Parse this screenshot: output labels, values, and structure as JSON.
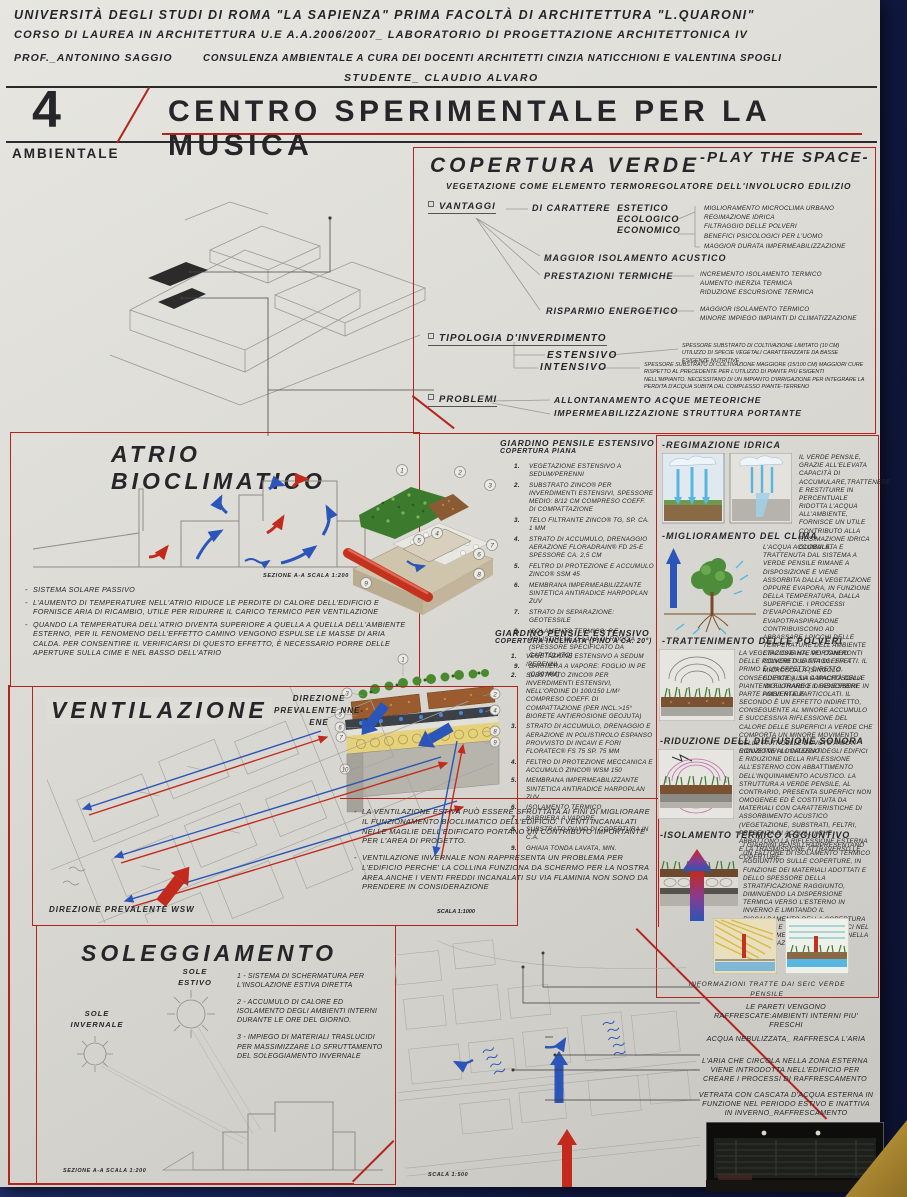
{
  "colors": {
    "accent_red": "#b2251f",
    "arrow_blue": "#2b55b8",
    "arrow_red": "#c32a1e",
    "paper": "#dcdbd5",
    "background_navy": "#121a44"
  },
  "header": {
    "line1": "UNIVERSITÀ DEGLI STUDI DI ROMA \"LA SAPIENZA\" PRIMA FACOLTÀ DI ARCHITETTURA \"L.QUARONI\"",
    "line2": "CORSO DI LAUREA IN ARCHITETTURA U.E  A.A.2006/2007_  LABORATORIO DI PROGETTAZIONE ARCHITETTONICA IV",
    "prof": "PROF._ANTONINO SAGGIO",
    "consulenza": "CONSULENZA AMBIENTALE A CURA DEI DOCENTI ARCHITETTI CINZIA NATICCHIONI E VALENTINA SPOGLI",
    "studente": "STUDENTE_ CLAUDIO ALVARO"
  },
  "title_block": {
    "number": "4",
    "label": "AMBIENTALE",
    "title": "CENTRO SPERIMENTALE PER LA MUSICA",
    "tagline": "-PLAY THE SPACE-"
  },
  "copertura_verde": {
    "title": "COPERTURA VERDE",
    "subtitle": "VEGETAZIONE COME ELEMENTO TERMOREGOLATORE DELL'INVOLUCRO EDILIZIO",
    "vantaggi_label": "VANTAGGI",
    "carattere_label": "DI CARATTERE",
    "caratteri": [
      "ESTETICO",
      "ECOLOGICO",
      "ECONOMICO"
    ],
    "caratteri_effetti": [
      "MIGLIORAMENTO MICROCLIMA URBANO",
      "REGIMAZIONE IDRICA",
      "FILTRAGGIO DELLE POLVERI",
      "BENEFICI PSICOLOGICI PER L'UOMO"
    ],
    "durata": "MAGGIOR DURATA IMPERMEABILIZZAZIONE",
    "acustico": "MAGGIOR ISOLAMENTO ACUSTICO",
    "prestazioni_label": "PRESTAZIONI TERMICHE",
    "prestazioni": [
      "INCREMENTO ISOLAMENTO TERMICO",
      "AUMENTO INERZIA TERMICA",
      "RIDUZIONE ESCURSIONE TERMICA"
    ],
    "risparmio_label": "RISPARMIO ENERGETICO",
    "risparmio": [
      "MAGGIOR ISOLAMENTO TERMICO",
      "MINORE IMPIEGO IMPIANTI DI CLIMATIZZAZIONE"
    ],
    "tipologia_label": "TIPOLOGIA D'INVERDIMENTO",
    "estensivo_label": "ESTENSIVO",
    "estensivo_text": "SPESSORE SUBSTRATO DI COLTIVAZIONE LIMITATO (10 CM) UTILIZZO DI SPECIE VEGETALI CARATTERIZZATE DA BASSE ESIGENZE NUTRITIVE",
    "intensivo_label": "INTENSIVO",
    "intensivo_text": "SPESSORE SUBSTRATO DI COLTIVAZIONE MAGGIORE (15/100 CM) MAGGIORI CURE RISPETTO AL PRECEDENTE PER L'UTILIZZO DI PIANTE PIÙ ESIGENTI NELL'IMPIANTO. NECESSITANO DI UN IMPIANTO D'IRRIGAZIONE PER INTEGRARE LA PERDITA D'ACQUA SUBITA DAL COMPLESSO PIANTE-TERRENO",
    "problemi_label": "PROBLEMI",
    "problemi": [
      "ALLONTANAMENTO ACQUE METEORICHE",
      "IMPERMEABILIZZAZIONE STRUTTURA PORTANTE"
    ]
  },
  "atrio": {
    "title": "ATRIO BIOCLIMATICO",
    "caption": "SEZIONE A-A SCALA 1:200",
    "bullets": [
      "SISTEMA SOLARE PASSIVO",
      "L'AUMENTO DI TEMPERATURE NELL'ATRIO RIDUCE LE PERDITE DI CALORE DELL'EDIFICIO E FORNISCE ARIA DI RICAMBIO, UTILE PER RIDURRE IL CARICO TERMICO PER VENTILAZIONE",
      "QUANDO LA TEMPERATURA DELL'ATRIO DIVENTA SUPERIORE A QUELLA A QUELLA DELL'AMBIENTE ESTERNO, PER IL FENOMENO DELL'EFFETTO CAMINO VENGONO ESPULSE LE MASSE DI ARIA CALDA. PER CONSENTIRE IL VERIFICARSI DI QUESTO EFFETTO, È NECESSARIO PORRE DELLE APERTURE SULLA CIME E NEL BASSO DELL'ATRIO"
    ]
  },
  "giardino_piana": {
    "title": "GIARDINO PENSILE ESTENSIVO",
    "subtitle": "COPERTURA PIANA",
    "items": [
      "VEGETAZIONE ESTENSIVO A SEDUM/PERENNI",
      "SUBSTRATO ZINCO® PER INVERDIMENTI ESTENSIVI, SPESSORE MEDIO: 8/12 CM COMPRESO COEFF. DI COMPATTAZIONE",
      "TELO FILTRANTE ZINCO® TG, SP. CA. 1 MM",
      "STRATO DI ACCUMULO, DRENAGGIO AERAZIONE FLORADRAIN® FD 25-E SPESSORE CA. 2,5 CM",
      "FELTRO DI PROTEZIONE E ACCUMULO ZINCO® SSM 45",
      "MEMBRANA IMPERMEABILIZZANTE SINTETICA ANTIRADICE HARPOPLAN ZUV",
      "STRATO DI SEPARAZIONE: GEOTESSILE",
      "ISOLAMENTO TERMICO: P.E. POLISTIRENE O LANA DI ROCCIA (SPESSORE SPECIFICATO DA CAPITOLATO)",
      "BARRIERA A VAPORE: FOGLIO IN PE (0,30 MM)"
    ]
  },
  "giardino_inclinata": {
    "title": "GIARDINO PENSILE ESTENSIVO",
    "subtitle": "COPERTURA INCLINATA (FINO A CA. 20°)",
    "items": [
      "VEGETAZIONE ESTENSIVO A SEDUM /PERENNI",
      "SUBSTRATO ZINCO® PER INVERDIMENTI ESTENSIVI, NELL'ORDINE DI 100/150 L/M² COMPRESO COEFF. DI COMPATTAZIONE (PER INCL.>15° BIORETE ANTIEROSIONE GEOJUTA)",
      "STRATO DI ACCUMULO, DRENAGGIO E AERAZIONE IN POLISTIROLO ESPANSO PROVVISTO DI INCAVI E FORI FLORATEC® FS 75 SP. 75 MM",
      "FELTRO DI PROTEZIONE MECCANICA E ACCUMULO ZINCO® WSM 150",
      "MEMBRANA IMPERMEABILIZZANTE SINTETICA ANTIRADICE HARPOPLAN ZUV",
      "ISOLAMENTO TERMICO",
      "BARRIERA A VAPORE",
      "SUBSTRATO PIANO DI COPERTURA IN C.A.",
      "GHIAIA TONDA LAVATA, MIN."
    ]
  },
  "ventilazione": {
    "title": "VENTILAZIONE",
    "dir_ne": "DIREZIONE PREVALENTE NNE-ENE",
    "dir_wsw": "DIREZIONE PREVALENTE WSW",
    "scala": "SCALA 1:1000",
    "notes": [
      "LA VENTILAZIONE ESTIVA PUÒ ESSERE SFRUTTATA AI FINI DI MIGLIORARE IL FUNZIONAMENTO BIOCLIMATICO DELL'EDIFICIO. I VENTI INCANALATI NELLE MAGLIE DELL'EDIFICATO PORTANO UN CONTRIBUTO IMPORTANTE PER L'AREA DI PROGETTO.",
      "VENTILAZIONE INVERNALE NON RAPPRESENTA UN PROBLEMA PER L'EDIFICIO PERCHE' LA COLLINA FUNZIONA DA SCHERMO PER LA NOSTRA AREA.ANCHE I VENTI FREDDI INCANALATI SU VIA FLAMINIA NON SONO DA PRENDERE IN CONSIDERAZIONE"
    ]
  },
  "right_column": {
    "sections": [
      {
        "title": "-REGIMAZIONE IDRICA",
        "text": "IL VERDE PENSILE, GRAZIE ALL'ELEVATA CAPACITÀ DI ACCUMULARE,TRATTENERE E RESTITUIRE IN PERCENTUALE RIDOTTA L'ACQUA ALL'AMBIENTE, FORNISCE UN UTILE CONTRIBUTO ALLA REGIMAZIONE IDRICA GLOBALE."
      },
      {
        "title": "-MIGLIORAMENTO DEL CLIMA",
        "text": "L'ACQUA ACCUMULATA E TRATTENUTA DAL SISTEMA A VERDE PENSILE RIMANE A DISPOSIZIONE E VIENE ASSORBITA DALLA VEGETAZIONE OPPURE EVAPORA, IN FUNZIONE DELLA TEMPERATURA, DALLA SUPERFICIE. I PROCESSI D'EVAPORAZIONE ED EVAPOTRASPIRAZIONE CONTRIBUISCONO AD ABBASSARE I PICCHI DELLE TEMPERATURE DELL'AMBIENTE CIRCOSTANTE PORTANDO CONCRETI VANTAGGI SIA A MICROSCALA (SINGOLO EDIFICIO), SIA A MACROSCALA MIGLIORANDO IL BENESSERE AMBIENTALE."
      },
      {
        "title": "-TRATTENIMENTO DELLE POLVERI",
        "text": "LA VEGETAZIONE HA, NEI CONFRONTI DELLE POLVERI DUE TIPI DI EFFETTI. IL PRIMO È UN EFFETTO DIRETTO, CONSEGUENTE ALLA CAPACITÀ DELLE PIANTE DI FILTRARE E DI ASSORBIRE IN PARTE POLVERI E PARTICOLATI. IL SECONDO È UN EFFETTO INDIRETTO, CONSEGUENTE AL MINORE ACCUMULO E SUCCESSIVA RIFLESSIONE DEL CALORE DELLE SUPERFICI A VERDE CHE COMPORTA UN MINORE MOVIMENTO DELLE PARTICELLE DOVUTO A MOTI CONVETTIVI LOCALIZZATI"
      },
      {
        "title": "-RIDUZIONE DELL DIFFUSIONE SONORA",
        "text": "RIDUZIONE ALL'INTERNO DEGLI EDIFICI E RIDUZIONE DELLA RIFLESSIONE ALL'ESTERNO CON ABBATTIMENTO DELL'INQUINAMENTO ACUSTICO. LA STRUTTURA A VERDE PENSILE, AL CONTRARIO, PRESENTA SUPERFICI NON OMOGENEE ED È COSTITUITA DA MATERIALI CON CARATTERISTICHE DI ASSORBIMENTO ACUSTICO (VEGETAZIONE, SUBSTRATI, FELTRI, PRESENZA DI ACQUA...) CHE ABBATTONO LA RIFLESSIONE ESTERNA E LA TRASMISSIONE ATTRAVERSO LE COPERTURE."
      },
      {
        "title": "-ISOLAMENTO TERMICO AGGIUNTIVO",
        "text": "I GIARDINI PENSILI RAPPRESENTANO UN FATTORE DI ISOLAMENTO TERMICO AGGIUNTIVO SULLE COPERTURE, IN FUNZIONE DEI MATERIALI ADOTTATI E DELLO SPESSORE DELLA STRATIFICAZIONE RAGGIUNTO, DIMINUENDO LA DISPERSIONE TERMICA VERSO L'ESTERNO IN INVERNO E LIMITANDO IL RISCALDAMENTO DELLA COPERTURA IN ESTATE E PORTANDO BENEFICI NEL RISCALDAMENTO INVERNALE E NELLA CLIMATIZZAZIONE ESTIVA."
      }
    ],
    "info_note": "INFORMAZIONI TRATTE DAI SEIC VERDE PENSILE"
  },
  "soleggiamento": {
    "title": "SOLEGGIAMENTO",
    "sole_estivo": "SOLE ESTIVO",
    "sole_invernale": "SOLE INVERNALE",
    "items": [
      "1 - SISTEMA DI SCHERMATURA PER L'INSOLAZIONE ESTIVA DIRETTA",
      "2 - ACCUMULO DI CALORE ED ISOLAMENTO DEGLI AMBIENTI INTERNI DURANTE LE ORE DEL GIORNO.",
      "3 - IMPIEGO DI MATERIALI TRASLUCIDI PER MASSIMIZZARE LO SFRUTTAMENTO DEL SOLEGGIAMENTO INVERNALE"
    ],
    "caption": "SEZIONE A-A SCALA 1:200"
  },
  "site_plan": {
    "scala": "SCALA 1:500",
    "callouts": [
      "LE PARETI VENGONO RAFFRESCATE:AMBIENTI INTERNI PIU' FRESCHI",
      "ACQUA NEBULIZZATA_ RAFFRESCA L'ARIA",
      "L'ARIA CHE CIRCOLA NELLA ZONA ESTERNA VIENE INTRODOTTA NELL'EDIFICIO PER CREARE I PROCESSI DI RAFFRESCAMENTO",
      "VETRATA CON CASCATA D'ACQUA ESTERNA IN FUNZIONE NEL PERIODO ESTIVO E INATTIVA IN INVERNO_RAFFRESCAMENTO"
    ]
  }
}
